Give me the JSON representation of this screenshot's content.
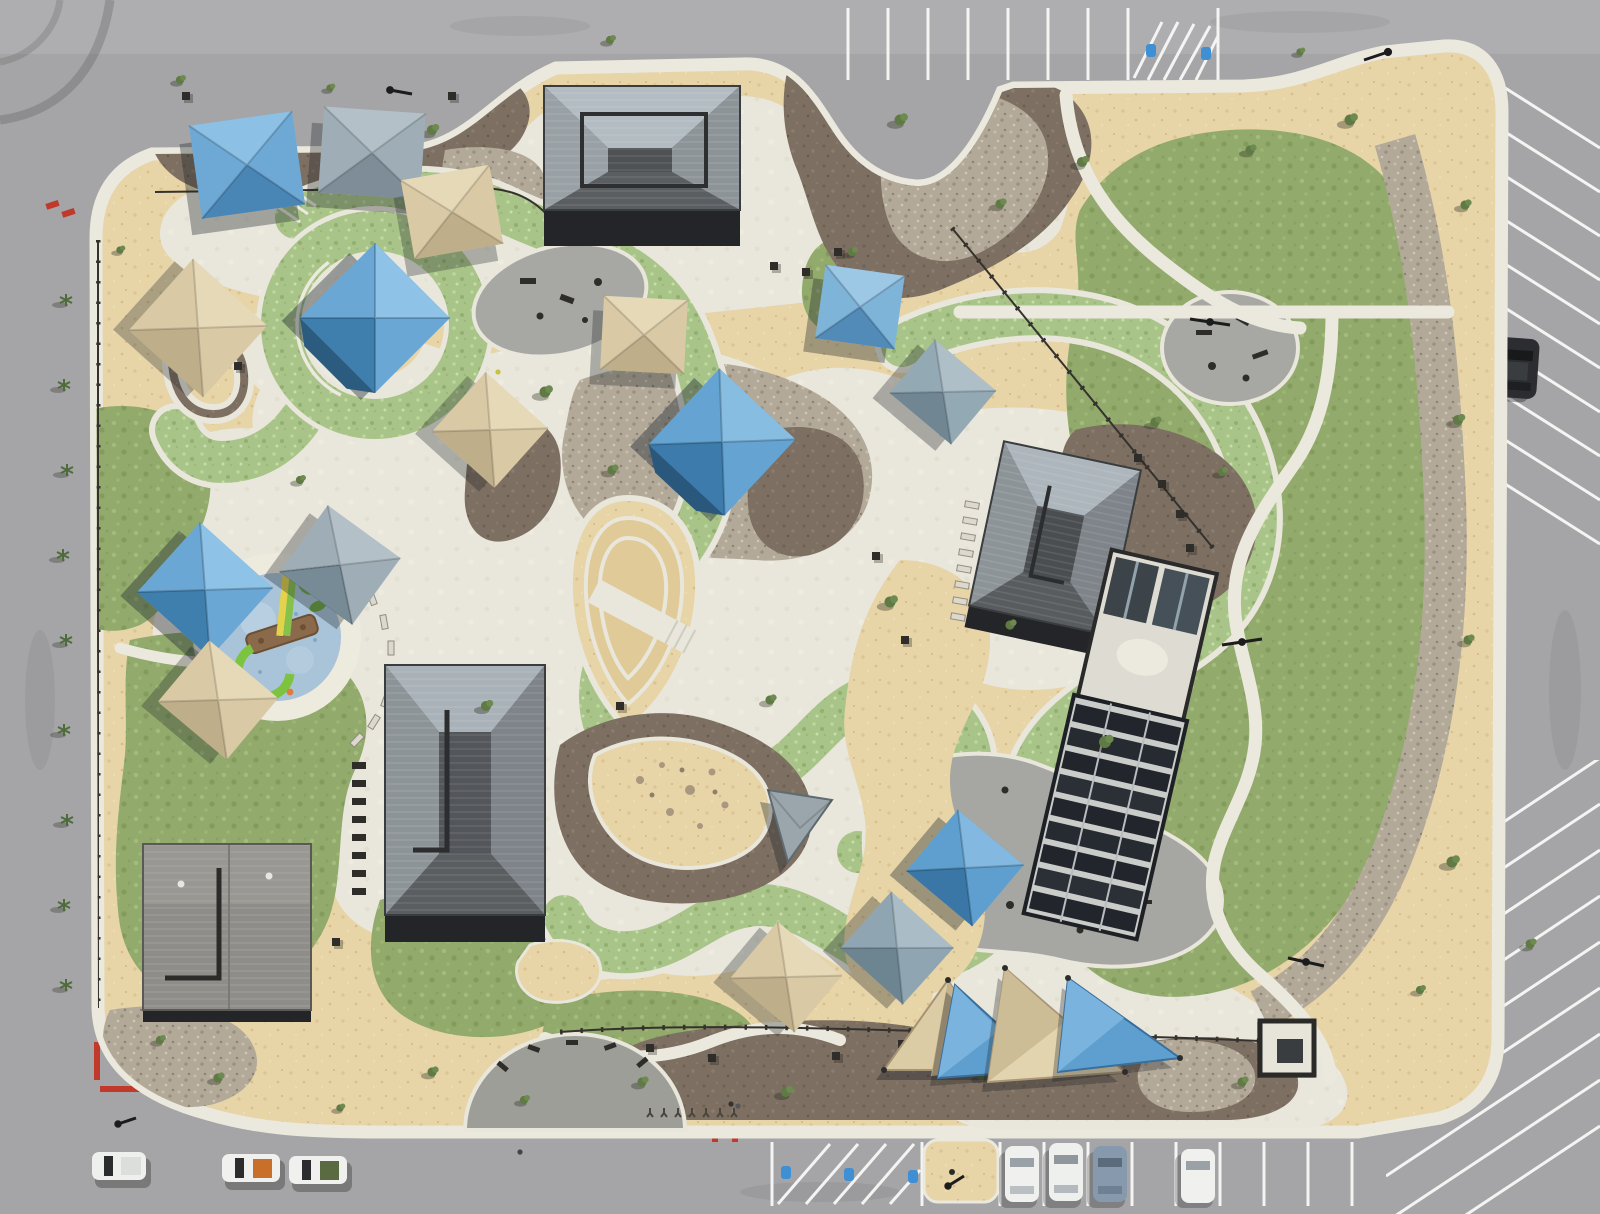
{
  "scene": {
    "title": "Aerial drone photo of a desert community park",
    "description": "Top-down aerial photograph of a large desert-landscaped community park bordered by gray asphalt streets and parking lots. The park contains three dark hip-roofed pavilions, a restroom building, a shade court with dark slatted canopy, a circular splash pad with lime-green and yellow water slides, many blue, tan and gray square shade sails, a cluster of triangular shade sails near the south parking, a bright green turf ribbon winding through the site with white concrete edges, sand play areas, brown mulch and river-rock beds, large irregular lawns crossed by curving white paths, black perimeter fencing, palm and shrub plantings, striped parking stalls with accessible hatching, and a few parked vehicles.",
    "palette": {
      "road": "#a5a5a7",
      "road_light": "#aeaeb0",
      "sidewalk": "#ebe8dd",
      "concrete": "#e9e6db",
      "desert_granite": "#e7d4a7",
      "lawn_green": "#92aa6c",
      "turf_ribbon_green": "#a9c489",
      "mulch_brown": "#7d6f61",
      "river_rock": "#b3a999",
      "sand": "#e0cb98",
      "rubber_surface": "#a7a7a3",
      "roof_dark": "#4e5254",
      "roof_light": "#aeb6ba",
      "shade_blue": "#6ea9d6",
      "shade_tan": "#d9c9a4",
      "shade_gray": "#9fadb6",
      "splash_pad_blue": "#a9c3d8",
      "slide_green": "#7cc340",
      "slide_yellow": "#e3d24b",
      "curb_red": "#c0392b",
      "stripe_white": "#f4f4f2",
      "accessible_blue": "#3f8fd4",
      "car_white": "#f0f1ef",
      "car_dark": "#2e3033",
      "car_blue_gray": "#8699ad"
    },
    "features": {
      "pavilions": [
        "north pavilion",
        "central pavilion",
        "east pavilion"
      ],
      "buildings": [
        "restroom building",
        "shade court with slatted canopy",
        "southeast entry kiosk"
      ],
      "play_areas": [
        "splash pad with slides",
        "sand loop track",
        "sand dig beach with boulders",
        "rubber-surface playground",
        "northeast fitness plaza",
        "oval play pad"
      ],
      "shade_structures": {
        "blue_square_sails": 6,
        "tan_square_sails": 5,
        "gray_square_sails": 4,
        "triangular_sails": 5
      },
      "landscape": [
        "turf ribbon loop",
        "lawns",
        "decomposed granite desert ground",
        "mulch beds",
        "river rock bands",
        "palms and shrubs"
      ],
      "vehicles": {
        "white_pickups_west_street": 3,
        "cars_south_lot": 4,
        "dark_suv_east_lot": 1,
        "dark_truck_southeast": 1
      },
      "parking": [
        "north stalls with accessible hatching",
        "south stalls with accessible hatching",
        "east angled stalls"
      ],
      "markings": [
        "white stall stripes",
        "blue accessible symbols",
        "red curb paint",
        "pavement stick-figure art"
      ]
    }
  }
}
